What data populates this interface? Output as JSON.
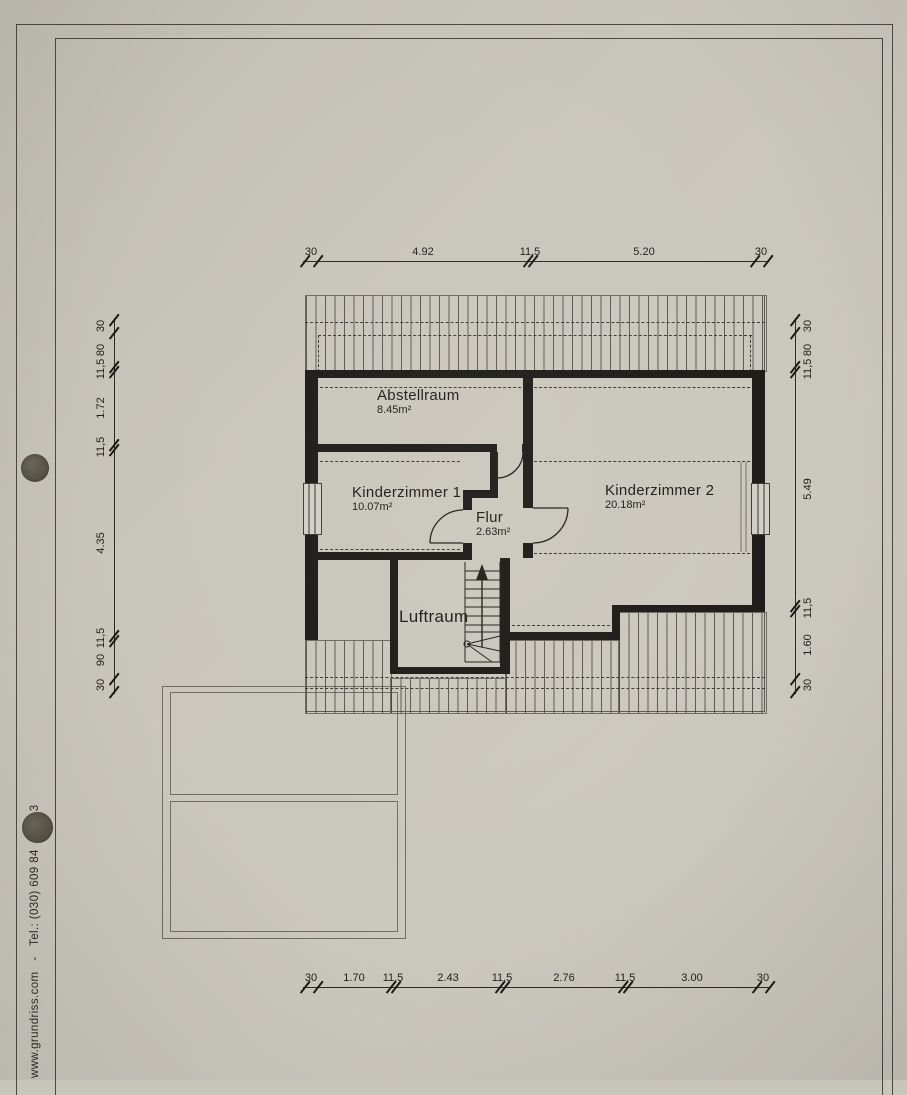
{
  "sheet": {
    "sidebar_text": "www.grundriss.com   -   Tel.: (030) 609 84",
    "sidebar_text_end": "3"
  },
  "rooms": [
    {
      "name": "Abstellraum",
      "area": "8.45m²"
    },
    {
      "name": "Kinderzimmer 1",
      "area": "10.07m²"
    },
    {
      "name": "Kinderzimmer 2",
      "area": "20.18m²"
    },
    {
      "name": "Flur",
      "area": "2.63m²"
    },
    {
      "name": "Luftraum",
      "area": ""
    }
  ],
  "dimensions": {
    "top": [
      "30",
      "4.92",
      "11,5",
      "5.20",
      "30"
    ],
    "bottom": [
      "30",
      "1.70",
      "11,5",
      "2.43",
      "11,5",
      "2.76",
      "11,5",
      "3.00",
      "30"
    ],
    "left": [
      "30",
      "80",
      "11,5",
      "1.72",
      "11,5",
      "4.35",
      "11,5",
      "90",
      "30"
    ],
    "right": [
      "30",
      "80",
      "11,5",
      "5.49",
      "11,5",
      "1.60",
      "30"
    ]
  },
  "colors": {
    "paper": "#c9c6bc",
    "wall": "#1d1c18",
    "line": "#3c3b35",
    "punch_hole": "#5a5447"
  }
}
